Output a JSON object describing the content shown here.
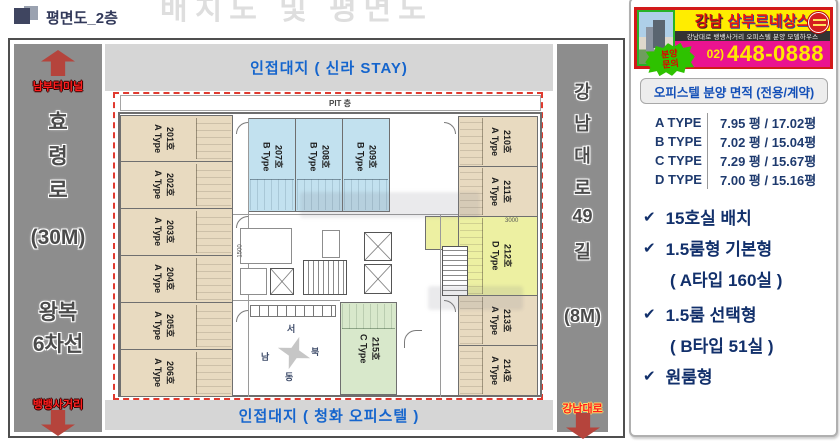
{
  "page": {
    "doc_title": "평면도_2층",
    "bg_heading": "배치도 및 평면도"
  },
  "roads": {
    "left": {
      "top_destination": "남부터미널",
      "name_chars": [
        "효",
        "령",
        "로"
      ],
      "width": "(30M)",
      "lanes": [
        "왕복",
        "6차선"
      ],
      "bottom_destination": "뱅뱅사거리"
    },
    "right": {
      "name_chars": [
        "강",
        "남",
        "대",
        "로",
        "49",
        "길"
      ],
      "width": "(8M)",
      "bottom_destination": "강남대로"
    }
  },
  "plan": {
    "adjacent_top": "인접대지 ( 신라 STAY)",
    "adjacent_bottom": "인접대지 ( 청화 오피스텔 )",
    "pit_label": "PIT 층",
    "dims": {
      "left": "1500",
      "right": "3000"
    },
    "compass": {
      "top": "서",
      "right": "북",
      "left": "남",
      "bottom": "동"
    },
    "units": [
      {
        "no": "201호",
        "type": "A Type"
      },
      {
        "no": "202호",
        "type": "A Type"
      },
      {
        "no": "203호",
        "type": "A Type"
      },
      {
        "no": "204호",
        "type": "A Type"
      },
      {
        "no": "205호",
        "type": "A Type"
      },
      {
        "no": "206호",
        "type": "A Type"
      },
      {
        "no": "207호",
        "type": "B Type"
      },
      {
        "no": "208호",
        "type": "B Type"
      },
      {
        "no": "209호",
        "type": "B Type"
      },
      {
        "no": "210호",
        "type": "A Type"
      },
      {
        "no": "211호",
        "type": "A Type"
      },
      {
        "no": "212호",
        "type": "D Type"
      },
      {
        "no": "213호",
        "type": "A Type"
      },
      {
        "no": "214호",
        "type": "A Type"
      },
      {
        "no": "215호",
        "type": "C Type"
      }
    ]
  },
  "sidebar": {
    "banner": {
      "title_area": "강남",
      "title_name": "삼부르네상스",
      "subtitle": "강남대로 뱅뱅사거리 오피스텔 분양 모델하우스",
      "inquiry_line1": "분양",
      "inquiry_line2": "문의",
      "phone_prefix": "02)",
      "phone": "448-0888"
    },
    "area_title": "오피스텔 분양 면적 (전용/계약)",
    "area_rows": [
      {
        "type": "A TYPE",
        "area": "7.95 평 / 17.02평"
      },
      {
        "type": "B TYPE",
        "area": "7.02 평 / 15.04평"
      },
      {
        "type": "C TYPE",
        "area": "7.29 평 / 15.67평"
      },
      {
        "type": "D TYPE",
        "area": "7.00 평 / 15.16평"
      }
    ],
    "features": [
      {
        "main": "15호실 배치",
        "sub": ""
      },
      {
        "main": "1.5룸형 기본형",
        "sub": "( A타입 160실 )"
      },
      {
        "main": "1.5룸 선택형",
        "sub": "( B타입 51실 )"
      },
      {
        "main": "원룸형",
        "sub": ""
      }
    ]
  }
}
